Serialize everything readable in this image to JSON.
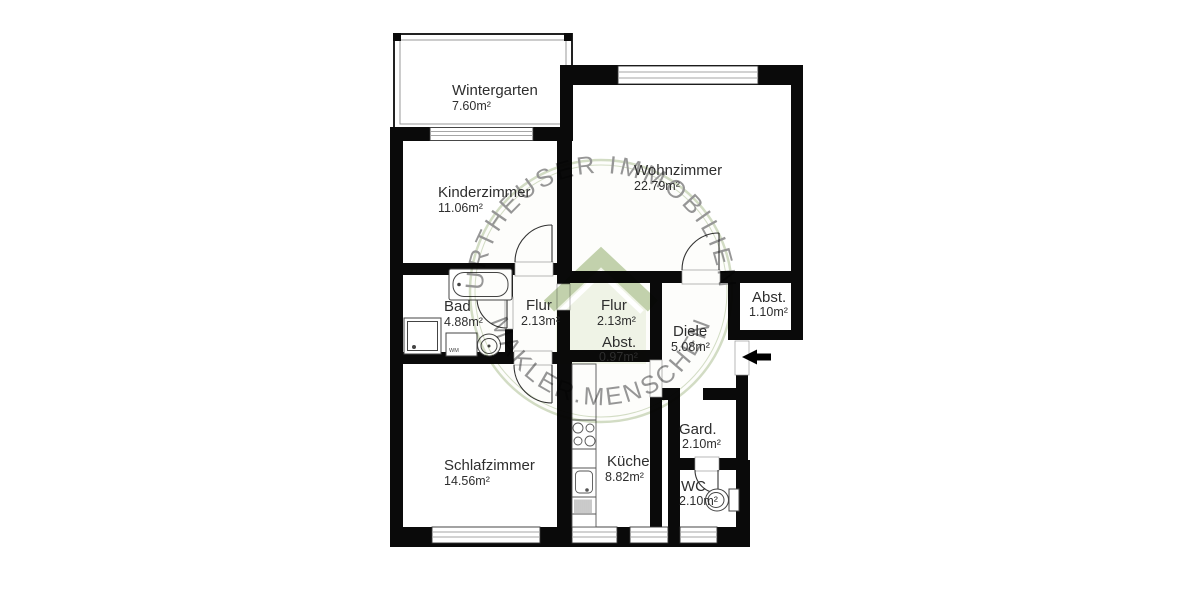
{
  "floorplan": {
    "title": "apartment-floor-plan",
    "rooms": {
      "wintergarten": {
        "name": "Wintergarten",
        "area": "7.60m²"
      },
      "kinderzimmer": {
        "name": "Kinderzimmer",
        "area": "11.06m²"
      },
      "wohnzimmer": {
        "name": "Wohnzimmer",
        "area": "22.79m²"
      },
      "bad": {
        "name": "Bad",
        "area": "4.88m²"
      },
      "flur_links": {
        "name": "Flur",
        "area": "2.13m²"
      },
      "flur_mitte": {
        "name": "Flur",
        "area": "2.13m²"
      },
      "abst_mitte": {
        "name": "Abst.",
        "area": "0.97m²"
      },
      "abst_eingang": {
        "name": "Abst.",
        "area": "1.10m²"
      },
      "diele": {
        "name": "Diele",
        "area": "5.08m²"
      },
      "schlafzimmer": {
        "name": "Schlafzimmer",
        "area": "14.56m²"
      },
      "kueche": {
        "name": "Küche",
        "area": "8.82m²"
      },
      "garderobe": {
        "name": "Gard.",
        "area": "2.10m²"
      },
      "wc": {
        "name": "WC",
        "area": "2.10m²"
      }
    },
    "fixtures": {
      "washing_machine_label": "WM"
    },
    "icons": {
      "entrance_arrow": "left-arrow"
    },
    "watermark": {
      "text_top": "URTHEUSER IMMOBILIEN",
      "text_bottom": "MAKLER.MENSCHEN",
      "ring_color": "#a6b989",
      "text_color": "#b2c296",
      "house_body_color": "#d9e4c4",
      "house_roof_color": "#85a35a"
    },
    "colors": {
      "wall": "#0a0a0a",
      "line": "#555555",
      "label": "#2e2e2e",
      "background": "#ffffff"
    }
  }
}
